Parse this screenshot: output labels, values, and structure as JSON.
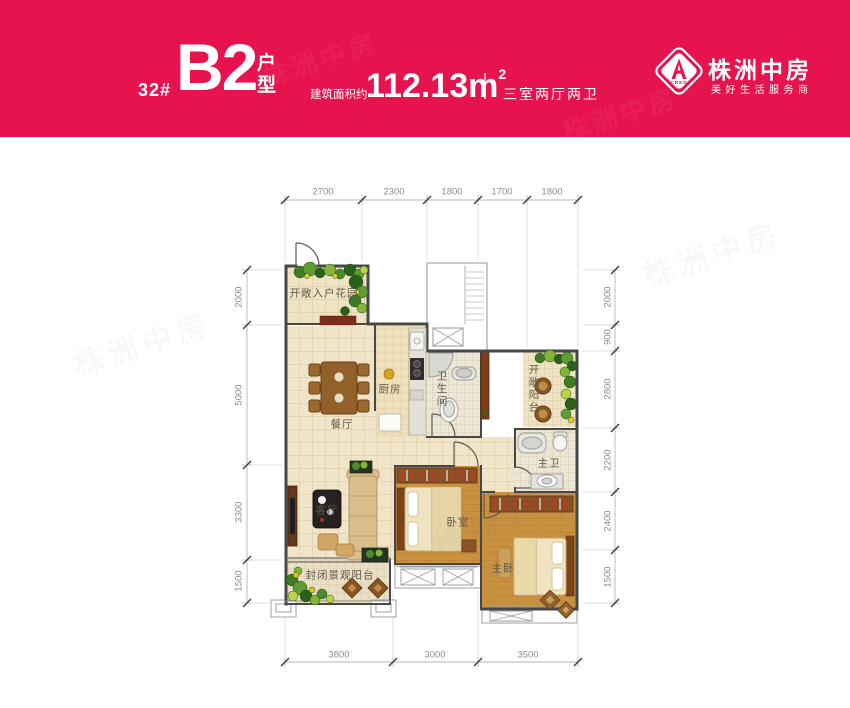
{
  "banner": {
    "unit_number": "32#",
    "unit_type": "B2",
    "unit_type_suffix": "户型",
    "area_label": "建筑面积约",
    "area_value": "112.13m",
    "area_superscript": "2",
    "layout_spec": "三室两厅两卫",
    "brand_name": "株洲中房",
    "brand_slogan": "美好生活服务商",
    "logo_monogram": "CRED",
    "background_color": "#e7134f"
  },
  "watermark": "株洲中房",
  "plan": {
    "rooms": {
      "entry_garden": {
        "label": "开敞入户花园"
      },
      "dining": {
        "label": "餐厅"
      },
      "kitchen": {
        "label": "厨房"
      },
      "bathroom": {
        "label": "卫生间"
      },
      "open_balcony": {
        "label": "开敞阳台"
      },
      "master_bath": {
        "label": "主卫"
      },
      "living": {
        "label": "客厅"
      },
      "bedroom": {
        "label": "卧室"
      },
      "master_bedroom": {
        "label": "主卧"
      },
      "enclosed_balcony": {
        "label": "封闭景观阳台"
      }
    },
    "dims": {
      "top": [
        "2700",
        "2300",
        "1800",
        "1700",
        "1800"
      ],
      "left": [
        "2000",
        "5000",
        "3300",
        "1500"
      ],
      "right": [
        "2000",
        "900",
        "2800",
        "2200",
        "2400",
        "1500"
      ],
      "bottom": [
        "3800",
        "3000",
        "3500"
      ]
    },
    "colors": {
      "wall": "#474747",
      "tile_floor": "#f0e5c8",
      "wood_floor": "#c9913f",
      "bath_floor": "#ebe6d6",
      "dim_text": "#8c8c8c",
      "room_label_text": "#5f584c",
      "plant_green": "#4c8a2f",
      "furniture_wood": "#8a5524"
    }
  }
}
